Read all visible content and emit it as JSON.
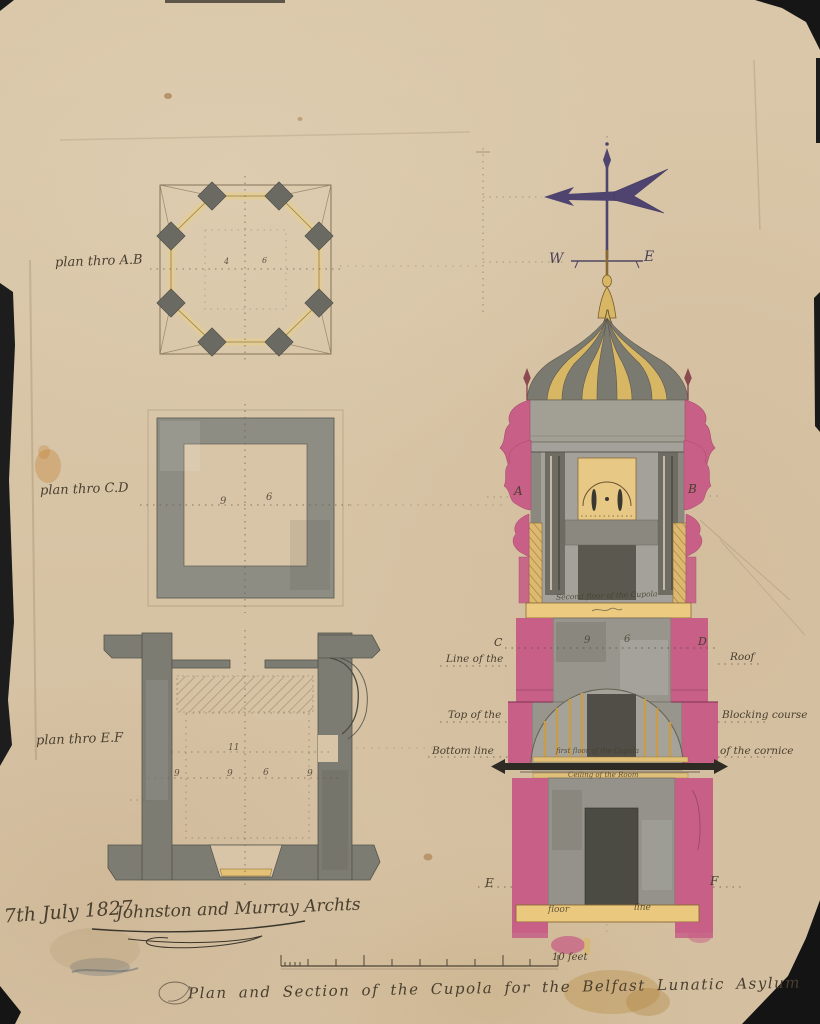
{
  "artwork": {
    "caption": "Plan and Section of the Cupola for the Belfast Lunatic Asylum",
    "date": "7th July 1827",
    "signature": "Johnston and Murray Archts",
    "scale_label": "10 feet"
  },
  "plans": {
    "ab": {
      "label": "plan thro A.B",
      "dims": [
        "4",
        "6"
      ]
    },
    "cd": {
      "label": "plan thro C.D",
      "dims": [
        "9",
        "6"
      ]
    },
    "ef": {
      "label": "plan thro E.F",
      "dims": [
        "11",
        "9",
        "9",
        "6",
        "9"
      ]
    }
  },
  "section": {
    "compass_w": "W",
    "compass_e": "E",
    "letter_a": "A",
    "letter_b": "B",
    "letter_c": "C",
    "letter_d": "D",
    "letter_e": "E",
    "letter_f": "F",
    "dim_9": "9",
    "dim_6": "6",
    "ann_second_floor": "Second floor of the Cupola",
    "ann_line_of_the": "Line of the",
    "ann_roof": "Roof",
    "ann_top_of_the": "Top of the",
    "ann_blocking_course": "Blocking course",
    "ann_bottom_line": "Bottom line",
    "ann_of_the_cornice": "of the cornice",
    "ann_first_floor": "first floor of the Cupola",
    "ann_ceiling": "Ceiling of the Room",
    "ann_floor": "floor",
    "ann_line": "line"
  },
  "colors": {
    "paper": "#d8c5a7",
    "ink": "#4a4134",
    "stone_gray": "#918f85",
    "dark_gray": "#565349",
    "wood_gold": "#e2c075",
    "pink_wash": "#c75f86",
    "purple_vane": "#4f4470",
    "backing_black": "#1a1a1a"
  }
}
